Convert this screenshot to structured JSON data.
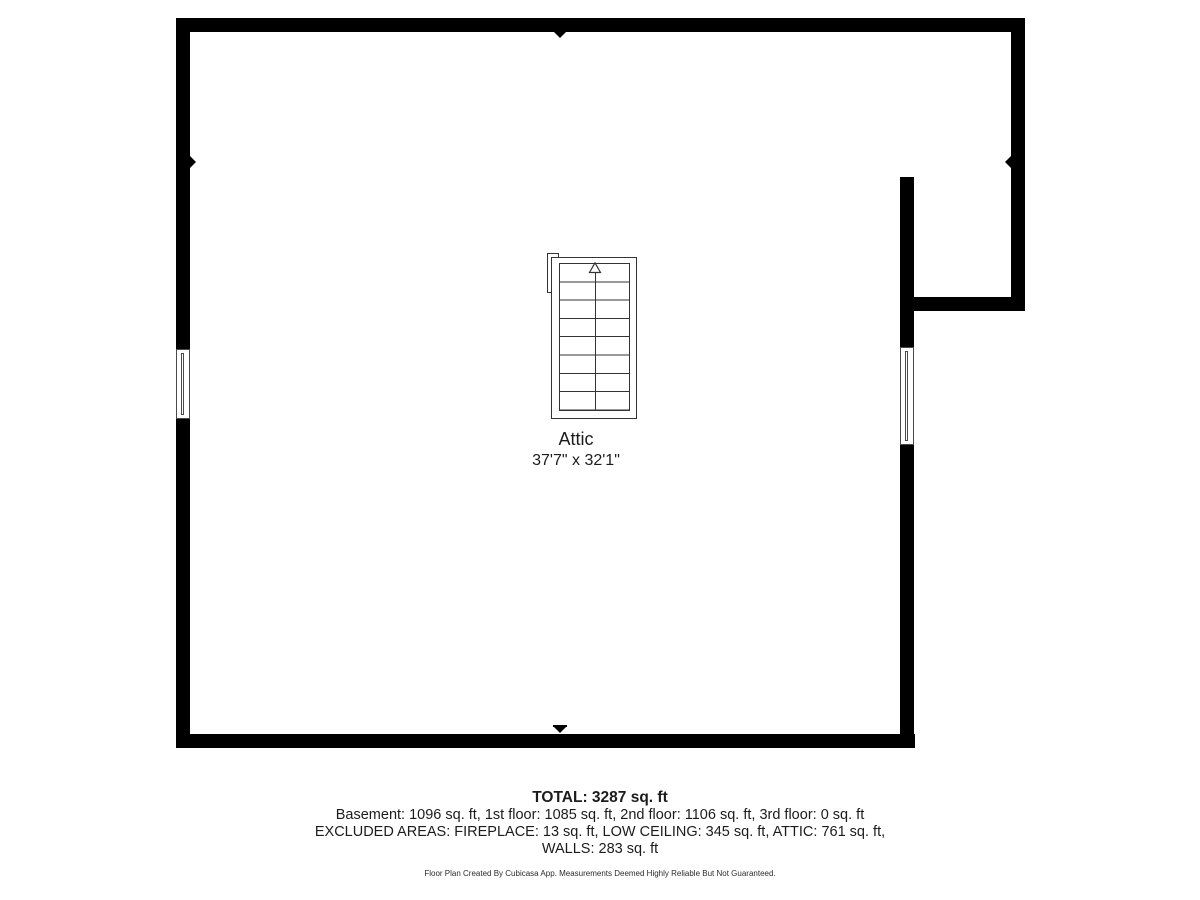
{
  "room": {
    "name": "Attic",
    "dimensions": "37'7\" x 32'1\""
  },
  "stairs": {
    "rows": 8,
    "direction": "up",
    "icon": "up-arrow"
  },
  "summary": {
    "total": "TOTAL: 3287 sq. ft",
    "floors": "Basement: 1096 sq. ft, 1st floor: 1085 sq. ft, 2nd floor: 1106 sq. ft, 3rd floor: 0 sq. ft",
    "excluded_line1": "EXCLUDED AREAS: FIREPLACE: 13 sq. ft, LOW CEILING: 345 sq. ft, ATTIC: 761 sq. ft,",
    "excluded_line2": "WALLS: 283 sq. ft",
    "disclaimer": "Floor Plan Created By Cubicasa App. Measurements Deemed Highly Reliable But Not Guaranteed."
  },
  "colors": {
    "wall": "#000000",
    "line": "#333333",
    "text": "#1c1c1c"
  }
}
